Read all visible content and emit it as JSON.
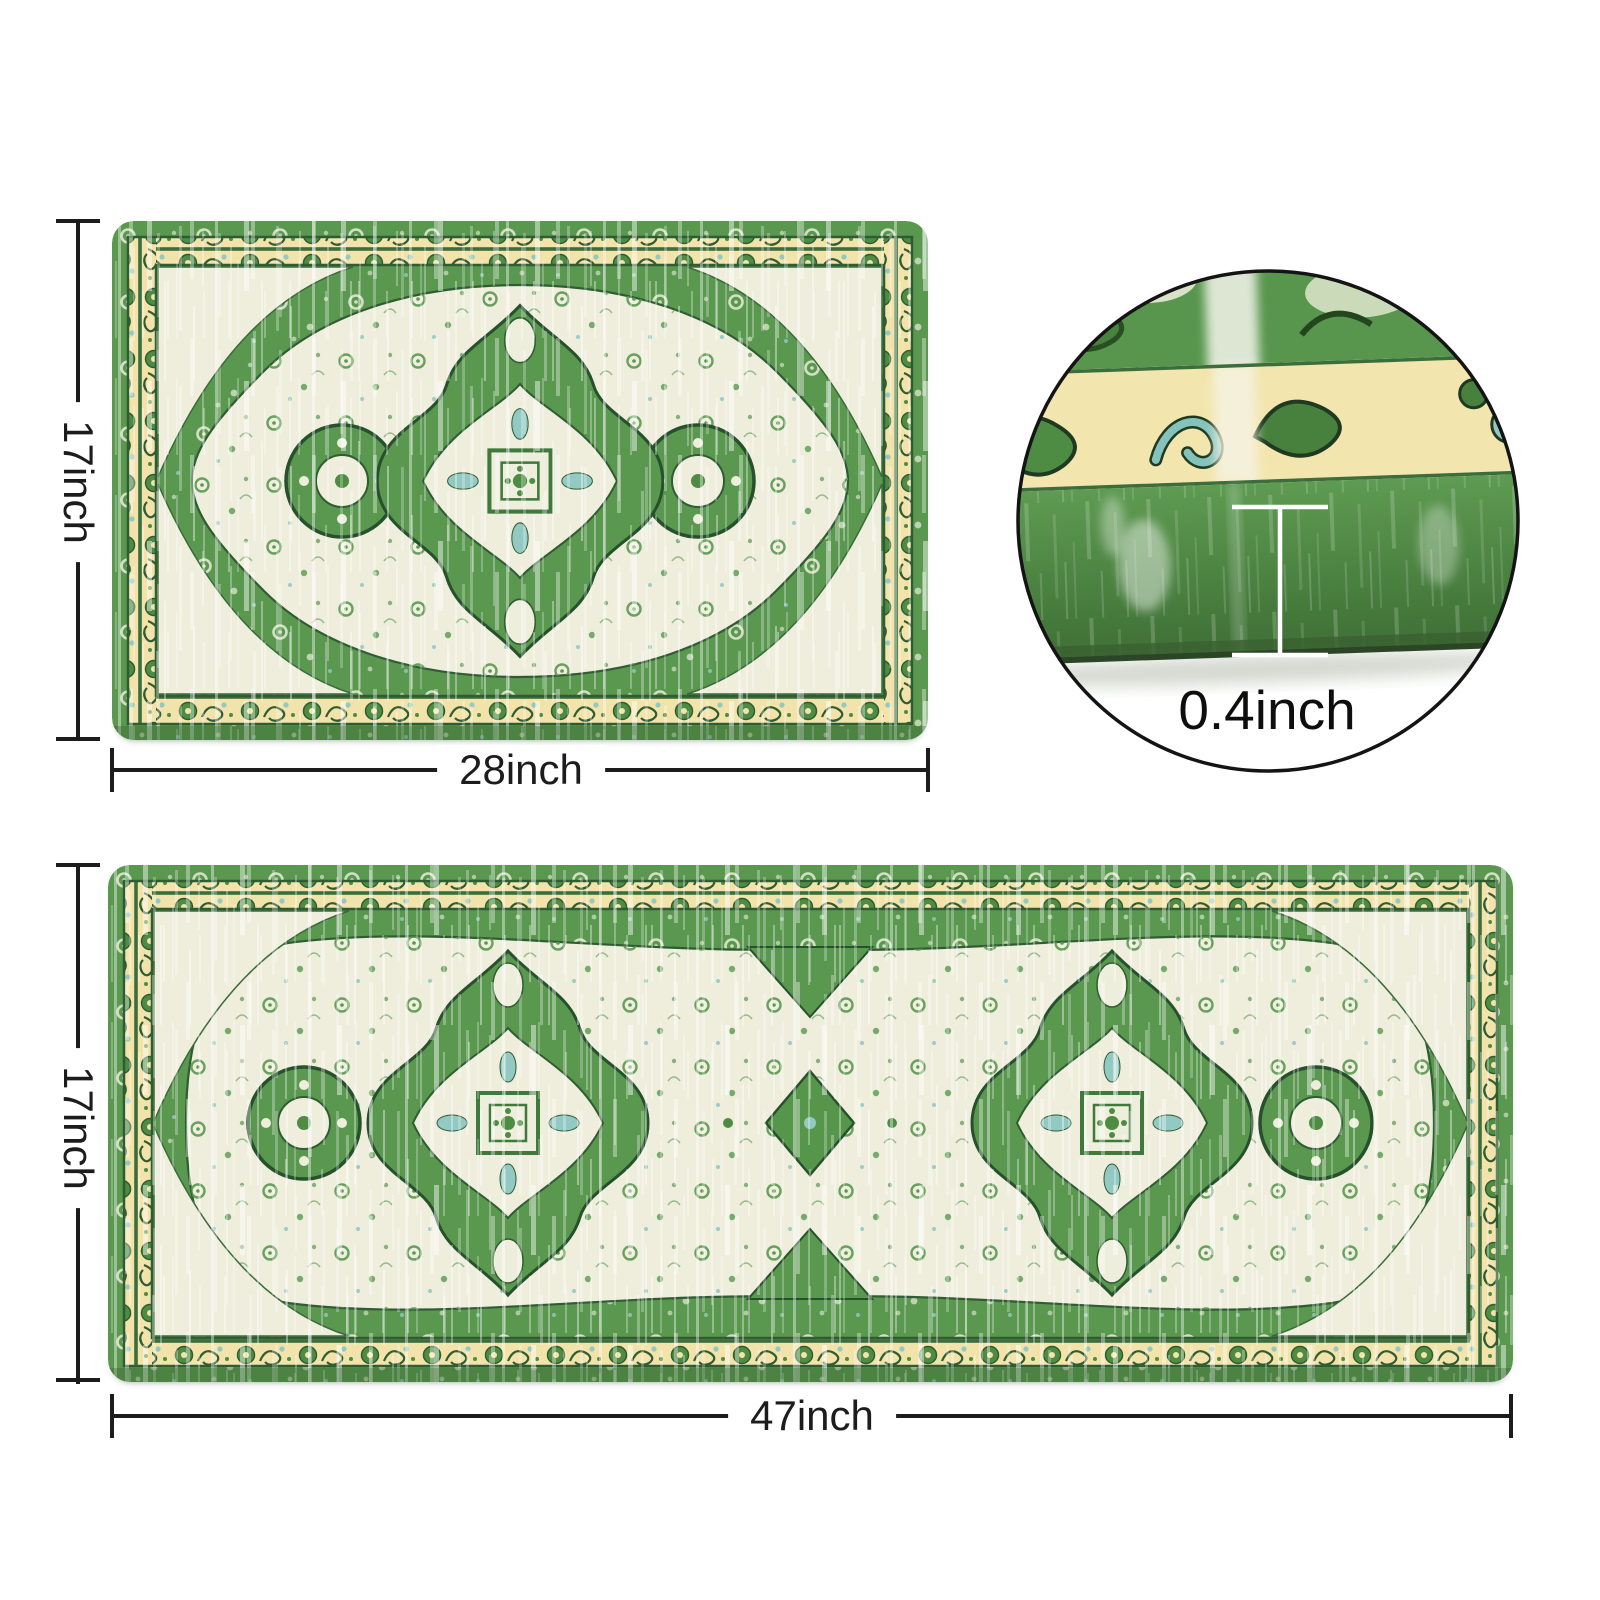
{
  "labels": {
    "small_mat_height": "17inch",
    "small_mat_width": "28inch",
    "runner_height": "17inch",
    "runner_width": "47inch",
    "thickness": "0.4inch"
  },
  "colors": {
    "bg": "#ffffff",
    "line": "#1c1c1c",
    "green": "#5a9850",
    "green_dark": "#2f5c33",
    "cream": "#efeedd",
    "yellow": "#f2e3aa",
    "teal": "#93c9c3"
  }
}
